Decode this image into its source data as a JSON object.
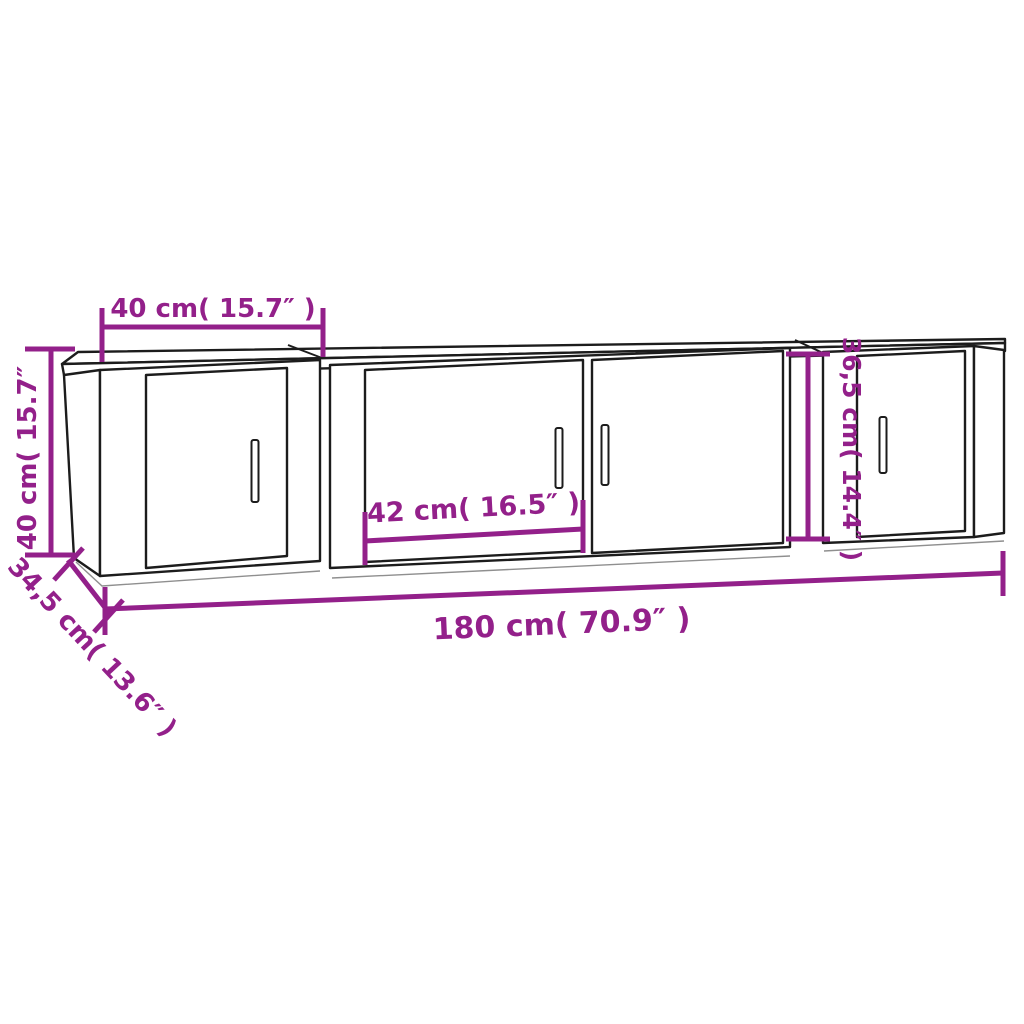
{
  "title": "3-piece TV cabinet set dimension diagram",
  "colors": {
    "dimension_accent": "#93208A",
    "outline": "#1c1c1c",
    "background": "#ffffff"
  },
  "dimensions": {
    "left_cabinet_width": "40 cm( 15.7″ )",
    "left_cabinet_height": "40 cm( 15.7″",
    "depth": "34,5 cm( 13.6″ )",
    "center_door_width": "42 cm( 16.5″ )",
    "right_cabinet_height": "36,5 cm( 14.4″ )",
    "total_width": "180 cm( 70.9″ )"
  }
}
